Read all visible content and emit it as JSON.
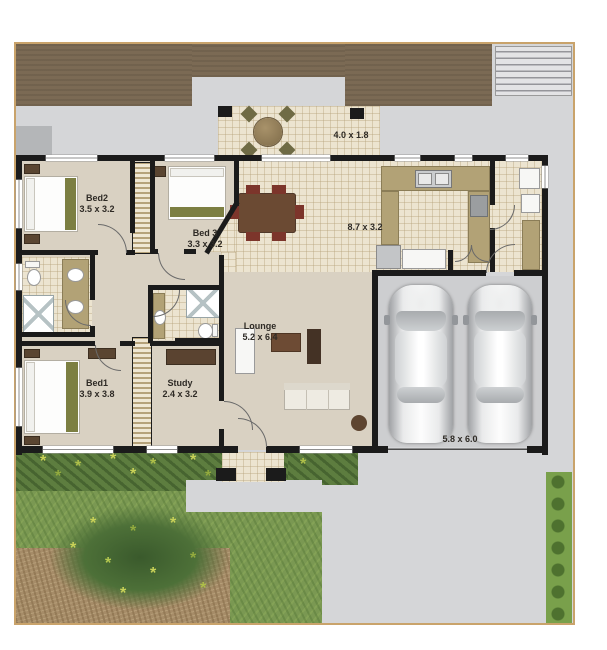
{
  "plan": {
    "rooms": {
      "bed1": {
        "name": "Bed1",
        "dims": "3.9 x 3.8"
      },
      "bed2": {
        "name": "Bed2",
        "dims": "3.5 x 3.2"
      },
      "bed3": {
        "name": "Bed 3",
        "dims": "3.3 x 3.2"
      },
      "study": {
        "name": "Study",
        "dims": "2.4 x 3.2"
      },
      "lounge": {
        "name": "Lounge",
        "dims": "5.2 x 6.4"
      },
      "meals_kitchen": {
        "dims": "8.7 x 3.2"
      },
      "patio": {
        "dims": "4.0 x 1.8"
      },
      "garage": {
        "dims": "5.8 x 6.0"
      }
    },
    "palette": {
      "site_border": "#c9a36b",
      "deck_timber": "#7b6a54",
      "concrete": "#d5d6d8",
      "wall": "#1b1b1b",
      "carpet": "#d9d1c2",
      "tile": "#ece4d0",
      "kitchen_counter": "#b2a276",
      "bedding_accent": "#7c7f42",
      "timber_furniture": "#6b4a33",
      "dining_chair": "#7c352b",
      "grass": "#7a9852",
      "shrub": "#5d7d3f",
      "dirt": "#a68c68",
      "hedge": "#79a04b",
      "garage_floor": "#cdced0"
    }
  }
}
